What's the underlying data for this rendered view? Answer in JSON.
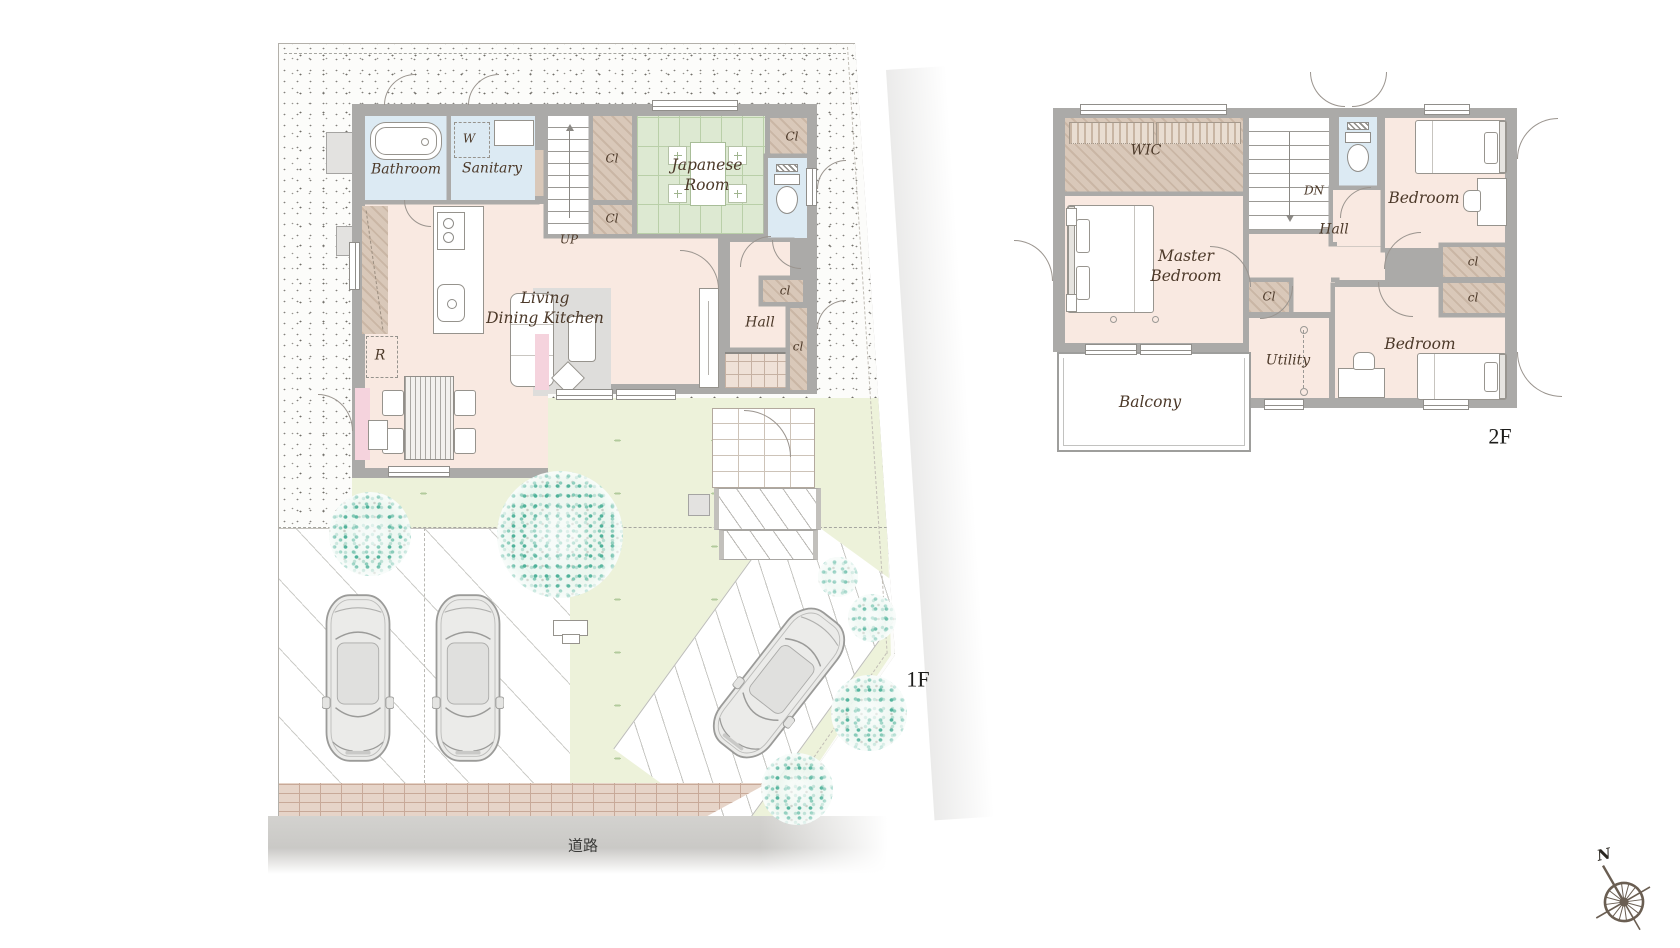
{
  "floor1": {
    "label": "1F",
    "road": "道路",
    "bathroom": "Bathroom",
    "washer": "W",
    "sanitary": "Sanitary",
    "up": "UP",
    "closet_tall": "Cl",
    "closet_small": "Cl",
    "japanese_1": "Japanese",
    "japanese_2": "Room",
    "closet_ne": "Cl",
    "ldk_1": "Living",
    "ldk_2": "Dining Kitchen",
    "hall": "Hall",
    "closet_hall_top": "cl",
    "closet_hall_side": "cl",
    "fridge": "R"
  },
  "floor2": {
    "label": "2F",
    "wic": "WIC",
    "master_1": "Master",
    "master_2": "Bedroom",
    "dn": "DN",
    "hall": "Hall",
    "bedroom_n": "Bedroom",
    "bedroom_s": "Bedroom",
    "closet_hall": "Cl",
    "closet_n": "cl",
    "closet_s": "cl",
    "utility": "Utility",
    "balcony": "Balcony"
  },
  "compass": {
    "north": "N"
  },
  "palette": {
    "wall": "#abaaa8",
    "floor": "#f9e9e1",
    "wet_room": "#dceaf3",
    "tatami": "#dde9d2",
    "closet": "#d9c8b9",
    "garden": "#edf2da",
    "tree": "#57b59c",
    "accent_pink": "#f5d3dd",
    "brick": "#e6d4c8"
  }
}
